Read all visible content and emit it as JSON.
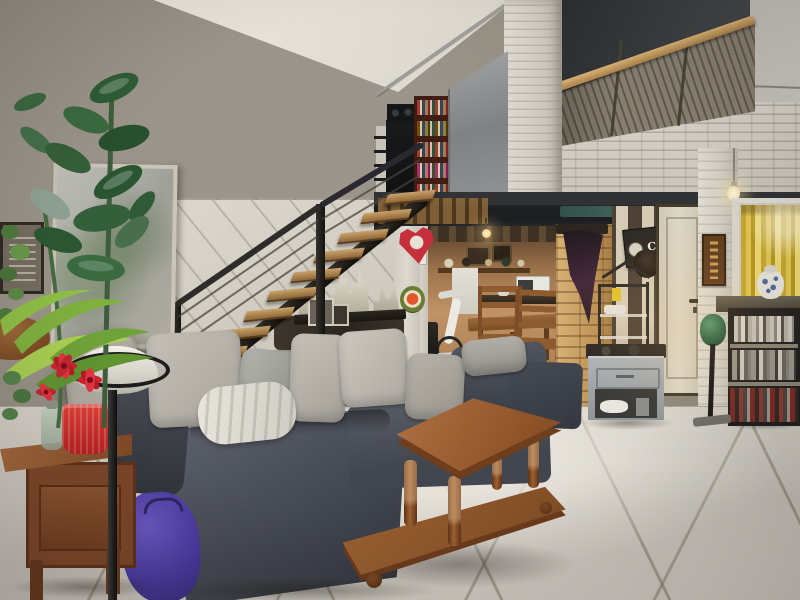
{
  "scene": {
    "type": "photograph",
    "setting": "loft living room with mezzanine",
    "description": "Industrial-style duplex living room: an open wooden staircase with cable railing rises along a white wall to a mezzanine fronted by grey louvered shutters and white stacked-stone pillars; beneath the black steel beam sits a warm-lit kitchen alcove with ladder-back dining chairs, a tan stacked-stone pillar with coat rack, a CAFE sign, a cream door and a yellow-curtained window over a dark media shelf; in the foreground a grey corner sofa with light cushions and a white throw, a purple bag, a turned-leg wooden coffee table on large beige floor tiles, a reddish-brown side table with a red pot, and tall houseplants in a white bowl planter on a black stand"
  },
  "signs": {
    "cafe_sign": "CAFE"
  },
  "palette": {
    "wall_greige": "#8f897c",
    "ceiling_cream": "#e2ded3",
    "ceiling_dark": "#33363a",
    "stone_white": "#d5d1c8",
    "stone_tan": "#c39a60",
    "beam_black": "#222425",
    "beam_teal": "#4b746a",
    "louver_grey": "#867e6f",
    "handrail_wood": "#c49a5e",
    "sofa_grey": "#4a4e57",
    "cushion_light": "#bcb8b0",
    "table_wood": "#9c6232",
    "tile_floor": "#cdc9c1",
    "curtain_yellow": "#ddbf4e",
    "plant_green": "#3a6a40",
    "accent_red": "#d02430",
    "bag_purple": "#4a3aa0"
  },
  "objects": [
    "mezzanine-balustrade",
    "bookshelf",
    "sliding-metal-panel",
    "staircase",
    "cable-railing",
    "kitchen-alcove",
    "dining-chairs",
    "microwave",
    "exercise-bike",
    "stone-pillar",
    "coat-rack",
    "cafe-sign",
    "entry-door",
    "yellow-curtain-window",
    "media-shelf",
    "shoe-cabinet",
    "stick-vacuum",
    "corner-sofa",
    "cushions",
    "white-throw",
    "purple-bag",
    "coffee-table",
    "side-table",
    "red-pot",
    "plant-stand",
    "houseplants",
    "mirror",
    "heart-decoration",
    "castle-figurines",
    "tile-floor"
  ]
}
